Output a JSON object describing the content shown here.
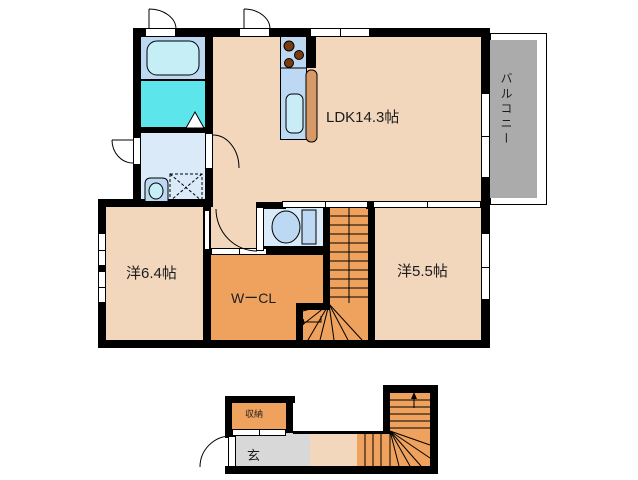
{
  "rooms": {
    "ldk": {
      "label": "LDK14.3帖"
    },
    "balcony": {
      "label": "バルコニー"
    },
    "western_6_4": {
      "label": "洋6.4帖"
    },
    "walk_in_closet": {
      "label": "WーCL"
    },
    "western_5_5": {
      "label": "洋5.5帖"
    },
    "storage": {
      "label": "収納"
    },
    "entrance": {
      "label": "玄"
    }
  },
  "fixtures": [
    "bathtub",
    "bathroom-floor",
    "folding-bath-door",
    "washbasin",
    "washing-machine-space",
    "toilet",
    "gas-stove",
    "kitchen-sink",
    "kitchen-counter",
    "casement-windows",
    "sliding-windows",
    "staircase-2f-with-winder",
    "staircase-1f-with-winder",
    "entrance-door",
    "balcony"
  ],
  "colors": {
    "wall": "#000000",
    "floor_main": "#F3D7BC",
    "floor_orange": "#EFA25D",
    "balcony_gray": "#ABABAB",
    "entrance_gray": "#D8D8D8",
    "fixture_blue": "#BCD8F2",
    "room_blue": "#DAEAF8",
    "tub_cyan": "#C6EEF6",
    "bath_floor_cyan": "#5CE6EB",
    "counter_tan": "#D79A66",
    "burner_brown": "#7B3B10"
  }
}
